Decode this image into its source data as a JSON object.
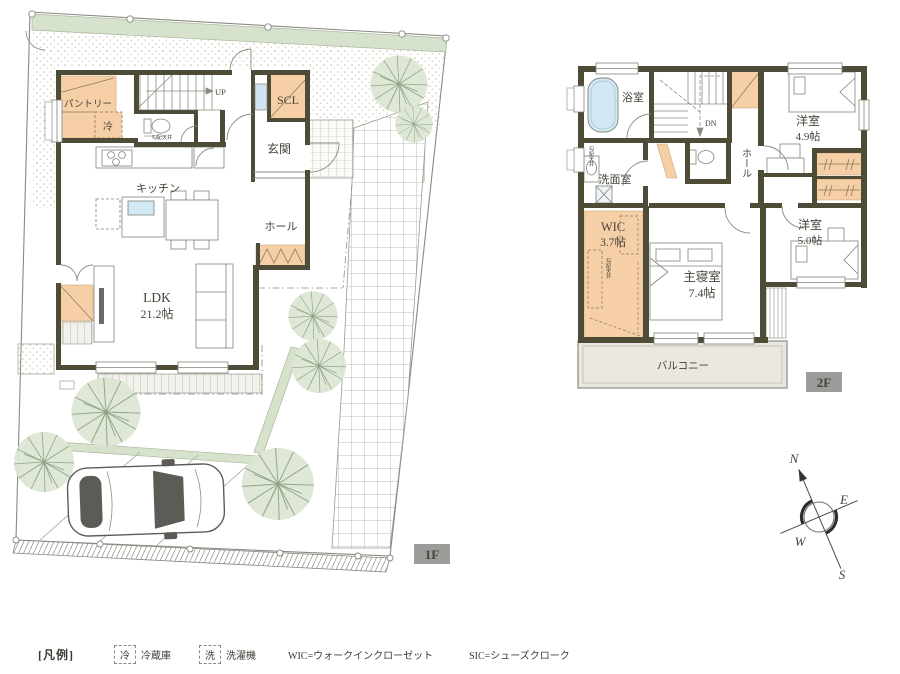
{
  "floor1": {
    "floor_label": "1F",
    "rooms": {
      "pantry": "パントリー",
      "fridge": "冷",
      "scl": "SCL",
      "genkan": "玄関",
      "kitchen": "キッチン",
      "hall": "ホール",
      "ldk": "LDK",
      "ldk_size": "21.2帖",
      "stair_direction": "UP",
      "sloped_ceiling": "勾配天井"
    }
  },
  "floor2": {
    "floor_label": "2F",
    "rooms": {
      "bath": "浴室",
      "washroom": "洗面室",
      "hall": "ホール",
      "western1": "洋室",
      "western1_size": "4.9帖",
      "western2": "洋室",
      "western2_size": "5.0帖",
      "wic": "WIC",
      "wic_size": "3.7帖",
      "master": "主寝室",
      "master_size": "7.4帖",
      "balcony": "バルコニー",
      "stair_direction": "DN",
      "sloped_ceiling": "勾配天井"
    }
  },
  "compass": {
    "north": "N",
    "east": "E",
    "south": "S",
    "west": "W"
  },
  "legend": {
    "title": "[凡例]",
    "items": [
      {
        "symbol": "冷",
        "label": "冷蔵庫"
      },
      {
        "symbol": "洗",
        "label": "洗濯機"
      },
      {
        "definition": "WIC=ウォークインクローゼット"
      },
      {
        "definition": "SIC=シューズクローク"
      }
    ]
  },
  "colors": {
    "wall": "#4e4b36",
    "closet_fill": "#f6cfa6",
    "tree": "#dce6d2",
    "bathtub": "#d2e8f2",
    "floor_label_bg": "#9c9c9a"
  }
}
